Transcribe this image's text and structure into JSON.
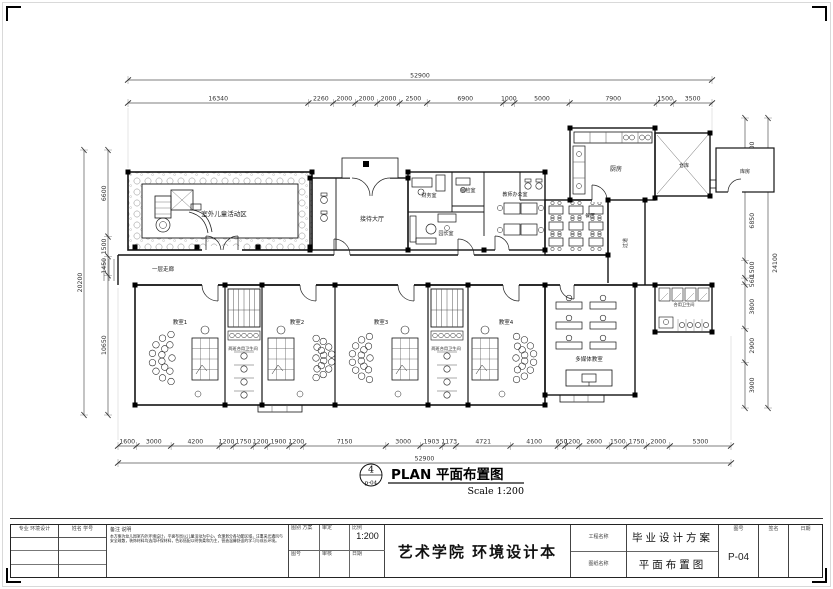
{
  "plan_title": {
    "circle_number": "4",
    "circle_ref": "p-04",
    "name": "PLAN  平面布置图",
    "scale": "Scale 1:200"
  },
  "dimensions": {
    "top_total": {
      "values": [
        "52900"
      ]
    },
    "top": {
      "values": [
        "16340",
        "2260",
        "2000",
        "2000",
        "2000",
        "2500",
        "6900",
        "1000",
        "5000",
        "7900",
        "1500",
        "3500"
      ]
    },
    "bottom": {
      "values": [
        "1600",
        "3000",
        "4200",
        "1200",
        "1750",
        "1200",
        "1900",
        "1200",
        "7150",
        "3000",
        "1903",
        "1173",
        "4721",
        "4100",
        "650",
        "1200",
        "2600",
        "1500",
        "1750",
        "2000",
        "5300"
      ]
    },
    "bottom_total": {
      "values": [
        "52900"
      ]
    },
    "left": {
      "values": [
        "6600",
        "1500",
        "1450",
        "10650"
      ]
    },
    "left_total": {
      "values": [
        "20200"
      ]
    },
    "right": {
      "values": [
        "5400",
        "6850",
        "1500",
        "560",
        "3800",
        "2900",
        "3900"
      ]
    },
    "right_total": {
      "values": [
        "24100"
      ]
    }
  },
  "rooms": {
    "outdoor_play": "室外儿童活动区",
    "lobby": "接待大厅",
    "finance": "财务室",
    "inspection": "晨检室",
    "teacher_office": "教师办公室",
    "director": "园长室",
    "kitchen": "厨房",
    "storage": "仓库",
    "storage2": "库房",
    "dining": "餐厅",
    "corridor": "一层走廊",
    "passage": "过道",
    "classroom1": "教室1",
    "classroom2": "教室2",
    "classroom3": "教室3",
    "classroom4": "教室4",
    "shared_bath1": "两班合用卫生间",
    "shared_bath2": "两班合用卫生间",
    "media_room": "多媒体教室",
    "wing_bath": "合用卫生间"
  },
  "titleblock": {
    "col1_header": "专业 环境设计",
    "col2_header": "姓名 学号",
    "note_header": "备注  说明",
    "note_text": "本方案为幼儿园室内外环境设计，平面布局以儿童活动为中心，合理划分各功能区域，注重采光通风与安全疏散，装饰材料均选用环保材料，色彩搭配以明快柔和为主，营造温馨舒适的学习与成长环境。",
    "cells": {
      "d1": "图别 方案",
      "d2": "审定",
      "d3": "比例",
      "scale": "1:200",
      "d4": "图号",
      "d5": "审核",
      "d6": "日期"
    },
    "project_title": "艺术学院 环境设计本",
    "label_project": "工程名称",
    "label_drawing": "图纸名称",
    "scheme": "毕业设计方案",
    "sheet_name": "平面布置图",
    "sheet_no_label": "图号",
    "sheet_no": "P-04",
    "sign_label": "签名",
    "date_label": "日期"
  }
}
